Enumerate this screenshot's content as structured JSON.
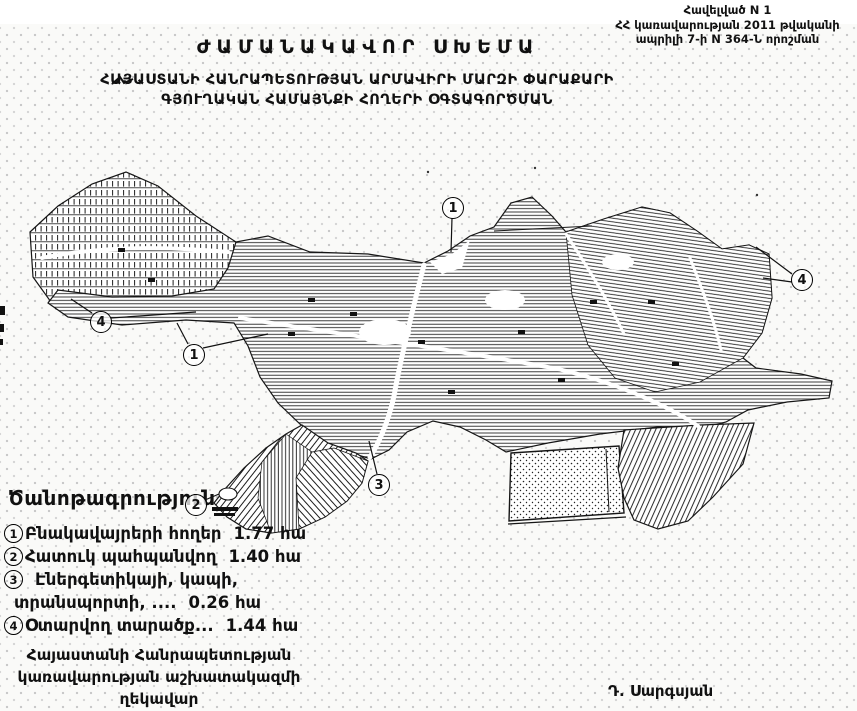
{
  "header": {
    "appendix_line1": "Հավելված N 1",
    "appendix_line2": "ՀՀ կառավարության 2011 թվականի",
    "appendix_line3": "ապրիլի 7-ի N 364-Ն որոշման",
    "title": "ԺԱՄԱՆԱԿԱՎՈՐ ՍԽԵՄԱ",
    "subtitle_line1": "ՀԱՅԱՍՏԱՆԻ ՀԱՆՐԱՊԵՏՈՒԹՅԱՆ ԱՐՄԱՎԻՐԻ ՄԱՐԶԻ ՓԱՐԱՔԱՐԻ",
    "subtitle_line2": "ԳՅՈՒՂԱԿԱՆ ՀԱՄԱՅՆՔԻ ՀՈՂԵՐԻ ՕԳՏԱԳՈՐԾՄԱՆ"
  },
  "map": {
    "callouts": {
      "top": "1",
      "west_outer": "4",
      "west_inner": "1",
      "east": "4",
      "southwest": "2",
      "south": "3"
    }
  },
  "legend": {
    "heading": "Ծանոթագրություն",
    "items": [
      {
        "num": "1",
        "text": "Բնակավայրերի հողեր",
        "value": "1.77 հա"
      },
      {
        "num": "2",
        "text": "Հատուկ պահպանվող",
        "value": "1.40 հա"
      },
      {
        "num": "3",
        "text": "Էներգետիկայի, կապի,",
        "text2": "տրանսպորտի,  ....",
        "value": "0.26 հա"
      },
      {
        "num": "4",
        "text": "Օտարվող տարածք...",
        "value": "1.44 հա"
      }
    ]
  },
  "footer": {
    "office_line1": "Հայաստանի Հանրապետության",
    "office_line2": "կառավարության աշխատակազմի",
    "office_line3": "ղեկավար",
    "signature": "Դ. Սարգսյան"
  },
  "colors": {
    "ink": "#111111",
    "paper": "#fafaf8",
    "halftone_dot": "#c7c7c7"
  }
}
